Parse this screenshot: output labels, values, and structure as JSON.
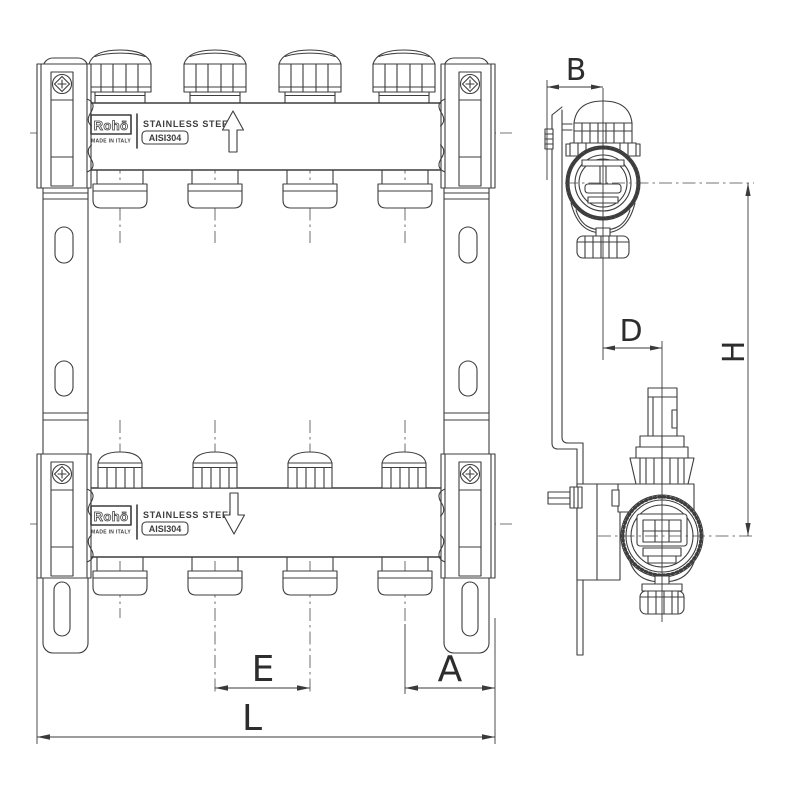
{
  "colors": {
    "line": "#3d3d3d",
    "text": "#2d2d2d",
    "background": "#ffffff"
  },
  "front_view": {
    "manifold_top": {
      "brand": "Rohō",
      "origin": "MADE IN ITALY",
      "material": "STAINLESS STEEL",
      "grade": "AISI304",
      "flow_direction": "up"
    },
    "manifold_bottom": {
      "brand": "Rohō",
      "origin": "MADE IN ITALY",
      "material": "STAINLESS STEEL",
      "grade": "AISI304",
      "flow_direction": "down"
    },
    "outlet_count": 4,
    "dimensions": {
      "outlet_spacing": "E",
      "end_to_outlet": "A",
      "overall_length": "L"
    }
  },
  "side_view": {
    "dimensions": {
      "bracket_depth": "B",
      "valve_axis_offset": "D",
      "axis_height": "H"
    }
  }
}
